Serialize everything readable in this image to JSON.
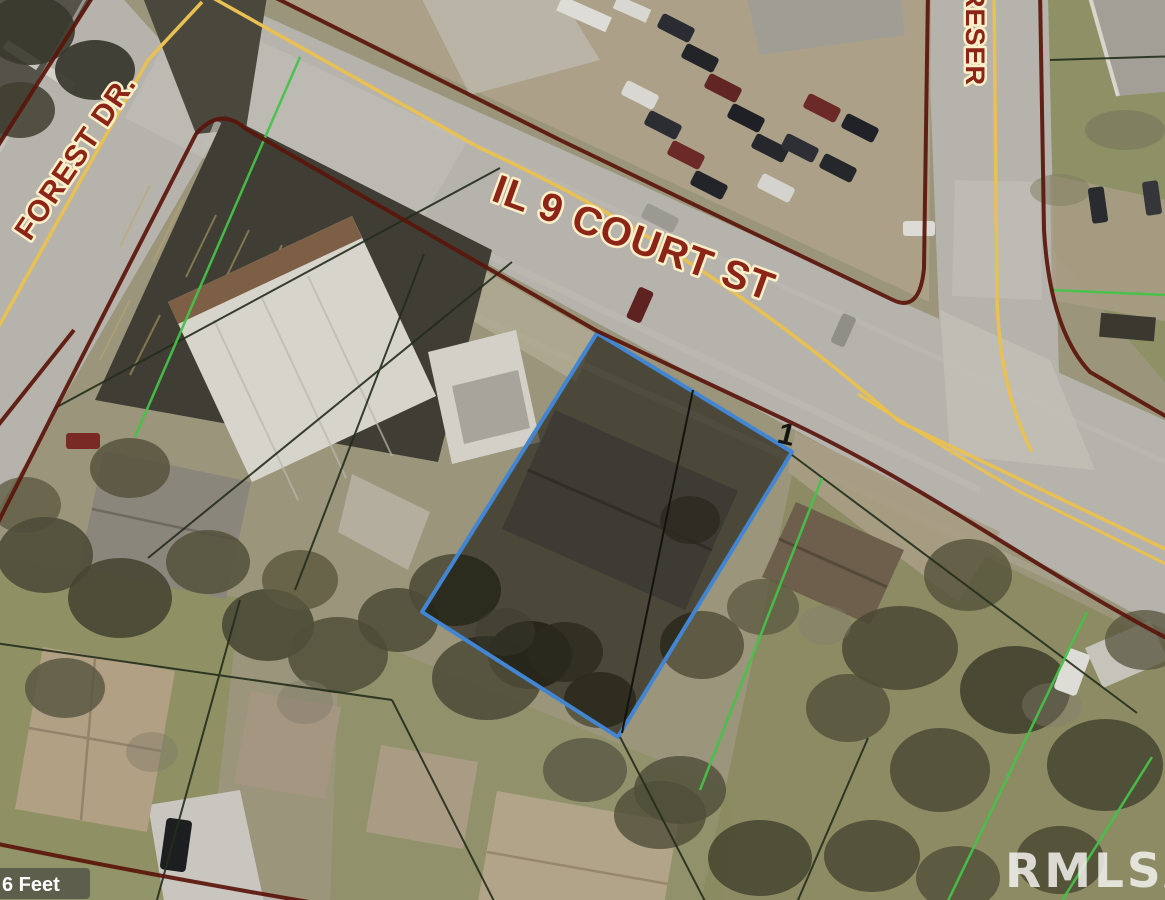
{
  "map": {
    "type": "aerial-parcel-map",
    "street_labels": [
      {
        "name": "forest-drive",
        "text": "FOREST DR."
      },
      {
        "name": "il-9-court-street",
        "text": "IL 9 COURT ST"
      },
      {
        "name": "reserve-street-partial",
        "text": "RESER"
      }
    ],
    "highlighted_parcel": {
      "number": "1",
      "border_color": "#4285d2",
      "fill": "rgba(10,10,4,0.55)"
    },
    "watermark": {
      "text": "RMLSA",
      "color": "rgba(242,242,238,0.85)"
    },
    "scale": {
      "text": "6 Feet"
    },
    "line_colors": {
      "subdivision_boundary_maroon": "#5a150b",
      "lot_line_green": "#46c249",
      "lot_line_dark": "#232d1b",
      "road_centerline_yellow": "#e9c052",
      "label_red": "#8c2418",
      "label_halo": "#fdf0c8"
    }
  }
}
